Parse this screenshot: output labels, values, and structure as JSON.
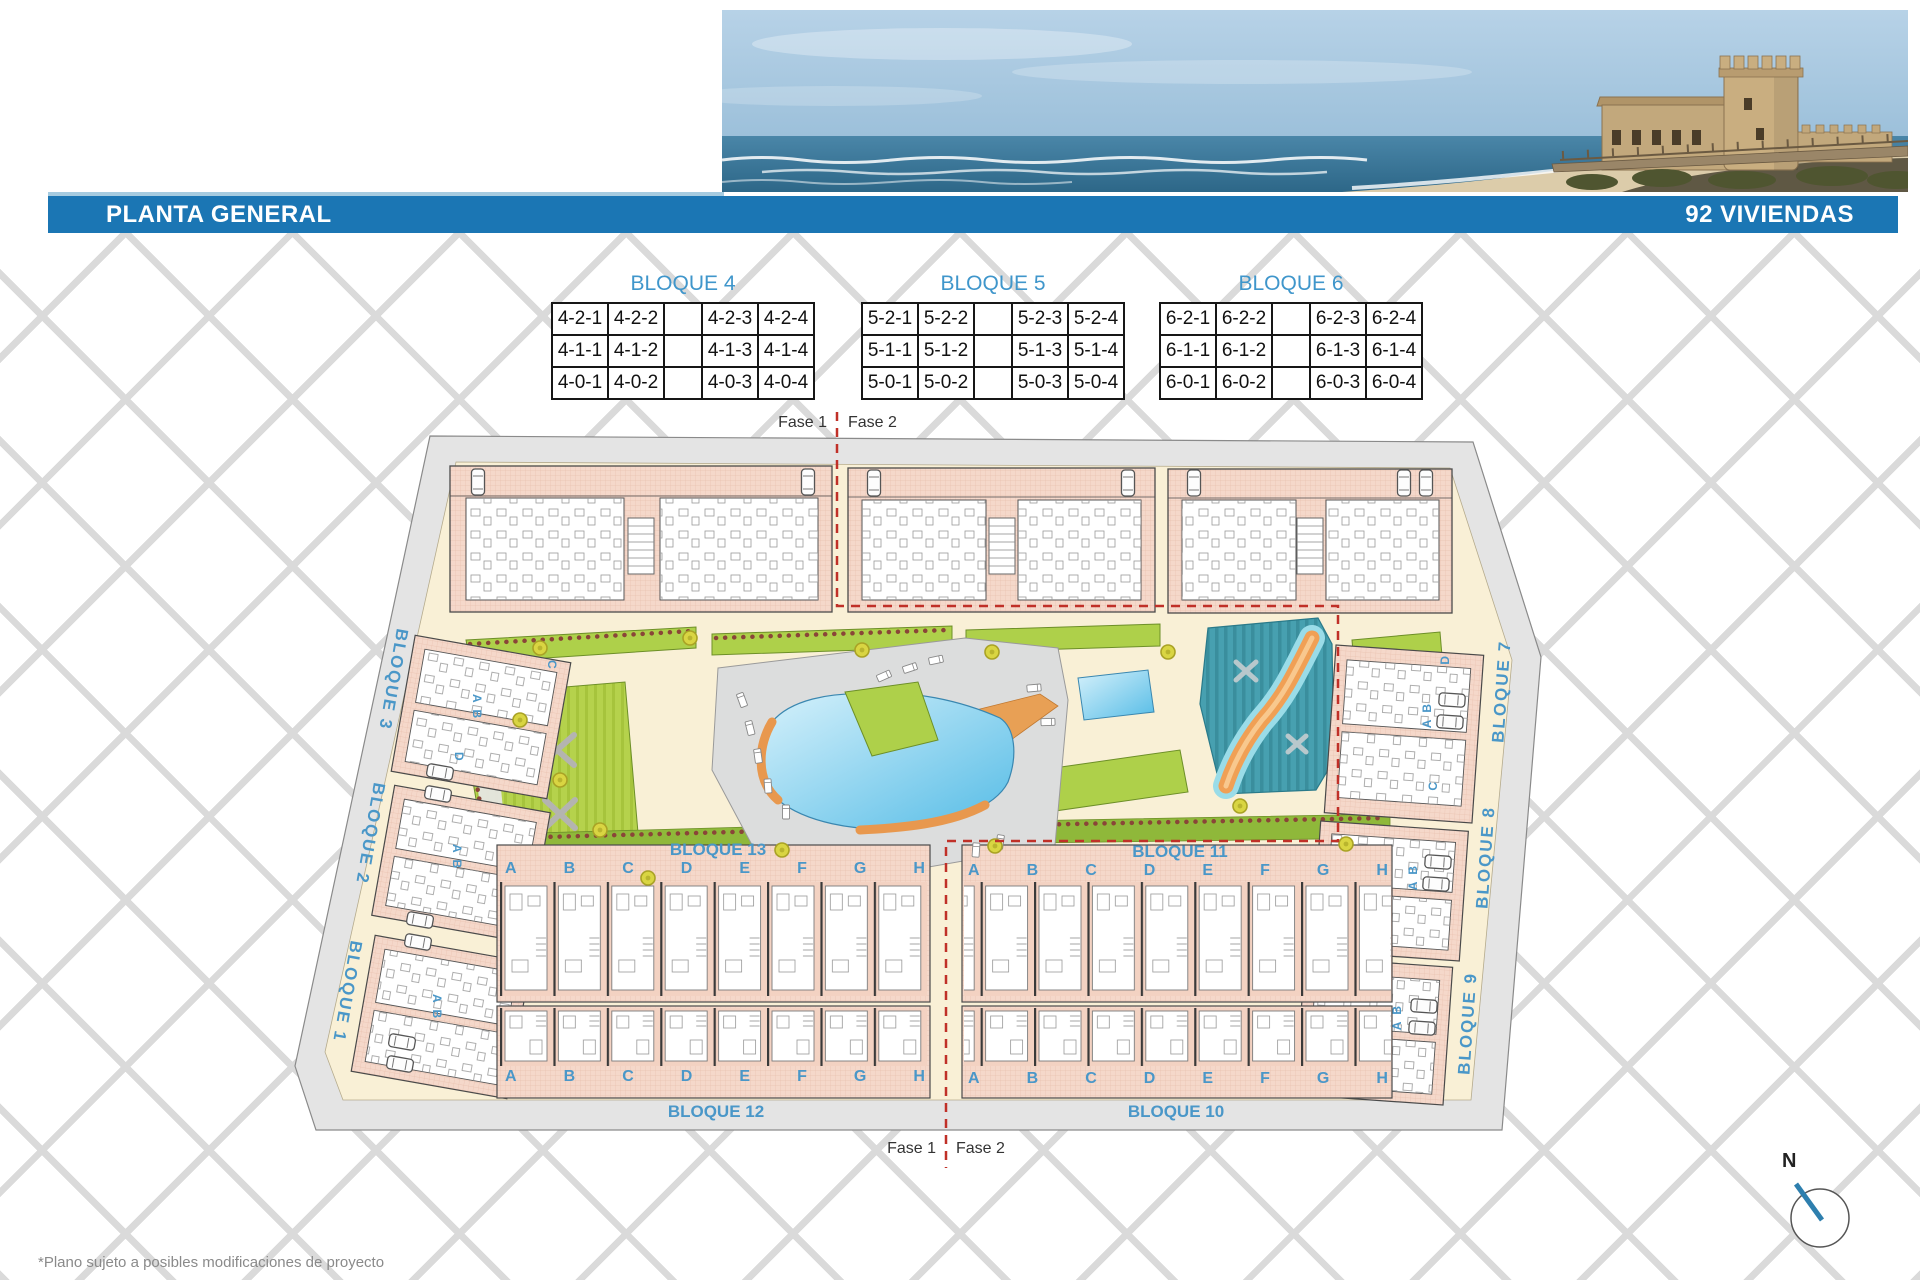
{
  "header": {
    "title": "PLANTA GENERAL",
    "units_total": "92 VIVIENDAS"
  },
  "bloque_tables": [
    {
      "title": "BLOQUE 4",
      "cells": [
        "4-2-1",
        "4-2-2",
        "",
        "4-2-3",
        "4-2-4",
        "4-1-1",
        "4-1-2",
        "",
        "4-1-3",
        "4-1-4",
        "4-0-1",
        "4-0-2",
        "",
        "4-0-3",
        "4-0-4"
      ]
    },
    {
      "title": "BLOQUE 5",
      "cells": [
        "5-2-1",
        "5-2-2",
        "",
        "5-2-3",
        "5-2-4",
        "5-1-1",
        "5-1-2",
        "",
        "5-1-3",
        "5-1-4",
        "5-0-1",
        "5-0-2",
        "",
        "5-0-3",
        "5-0-4"
      ]
    },
    {
      "title": "BLOQUE 6",
      "cells": [
        "6-2-1",
        "6-2-2",
        "",
        "6-2-3",
        "6-2-4",
        "6-1-1",
        "6-1-2",
        "",
        "6-1-3",
        "6-1-4",
        "6-0-1",
        "6-0-2",
        "",
        "6-0-3",
        "6-0-4"
      ]
    }
  ],
  "plan": {
    "fase1": "Fase 1",
    "fase2": "Fase 2",
    "blocks": {
      "b1": "BLOQUE 1",
      "b2": "BLOQUE 2",
      "b3": "BLOQUE 3",
      "b7": "BLOQUE 7",
      "b8": "BLOQUE 8",
      "b9": "BLOQUE 9",
      "b10": "BLOQUE 10",
      "b11": "BLOQUE 11",
      "b12": "BLOQUE 12",
      "b13": "BLOQUE 13"
    },
    "unit_letters": [
      "A",
      "B",
      "C",
      "D",
      "E",
      "F",
      "G",
      "H"
    ],
    "side_letters": {
      "ab": "A B",
      "dc": "D C",
      "c": "C",
      "d": "D"
    }
  },
  "compass": {
    "north_label": "N"
  },
  "footer": {
    "disclaimer": "*Plano sujeto a posibles modificaciones de proyecto"
  },
  "colors": {
    "bar_blue": "#1b76b4",
    "label_blue": "#4a97c8",
    "table_title_blue": "#3f96cb",
    "phase_red": "#c03028",
    "building_pink": "#f5d8ca",
    "garden_green": "#aed04a",
    "pool_blue": "#55bce6",
    "splash_teal": "#47a0b0",
    "river_orange": "#f0a055",
    "road_gray": "#e4e4e4",
    "site_cream": "#f9f0d6"
  }
}
